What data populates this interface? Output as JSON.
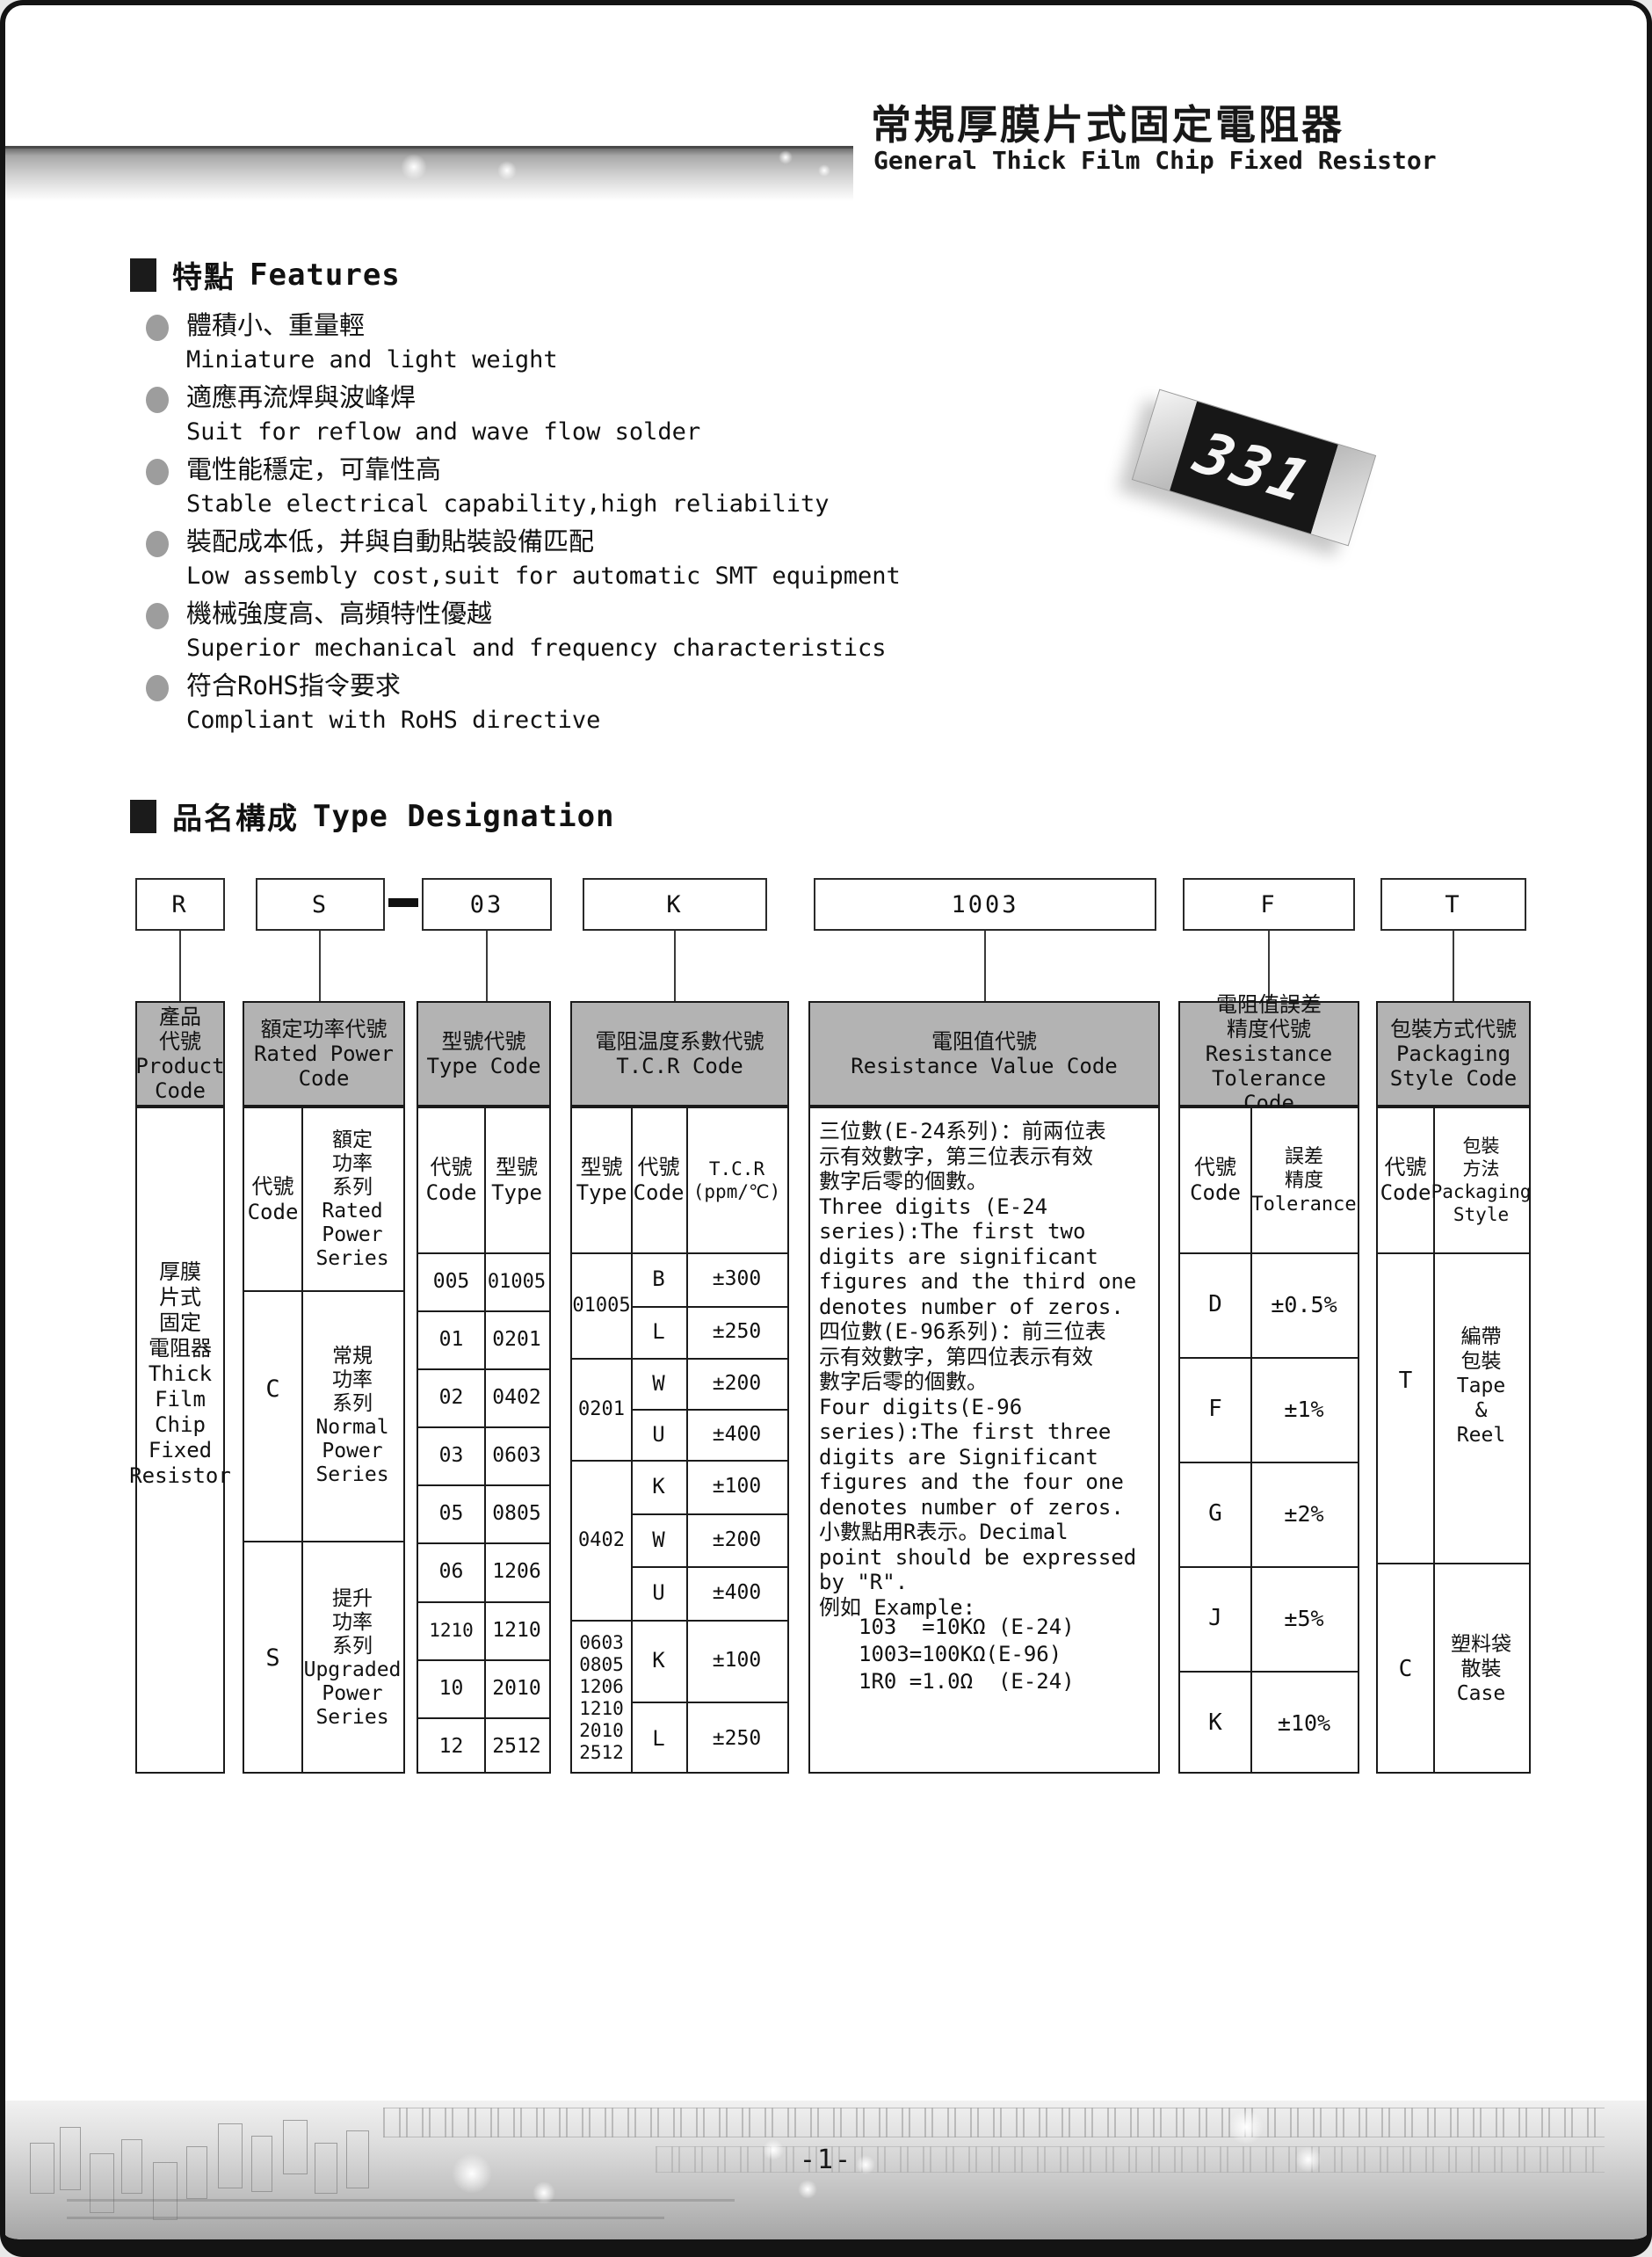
{
  "header": {
    "title_zh": "常規厚膜片式固定電阻器",
    "title_en": "General Thick Film Chip Fixed Resistor"
  },
  "features": {
    "heading_zh": "特點",
    "heading_en": "Features",
    "items": [
      {
        "zh": "體積小、重量輕",
        "en": "Miniature and light weight"
      },
      {
        "zh": "適應再流焊與波峰焊",
        "en": "Suit for reflow and wave flow solder"
      },
      {
        "zh": "電性能穩定，可靠性高",
        "en": "Stable electrical capability,high reliability"
      },
      {
        "zh": "裝配成本低，并與自動貼裝設備匹配",
        "en": "Low assembly cost,suit for automatic SMT equipment"
      },
      {
        "zh": "機械強度高、高頻特性優越",
        "en": "Superior mechanical and frequency characteristics"
      },
      {
        "zh": "符合RoHS指令要求",
        "en": "Compliant with RoHS directive"
      }
    ]
  },
  "chip": {
    "marking": "331"
  },
  "type_designation": {
    "heading_zh": "品名構成",
    "heading_en": "Type Designation",
    "codes": [
      "R",
      "S",
      "03",
      "K",
      "1003",
      "F",
      "T"
    ]
  },
  "table": {
    "headers": {
      "product": "產品\n代號\nProduct\nCode",
      "rated_power": "額定功率代號\nRated Power\nCode",
      "type": "型號代號\nType Code",
      "tcr": "電阻温度系數代號\nT.C.R Code",
      "resistance": "電阻值代號\nResistance Value Code",
      "tolerance": "電阻值誤差\n精度代號\nResistance\nTolerance Code",
      "packaging": "包裝方式代號\nPackaging\nStyle Code"
    },
    "subheaders": {
      "code": "代號\nCode",
      "rated_power_series": "額定\n功率\n系列\nRated\nPower\nSeries",
      "type_model": "型號\nType",
      "tcr_unit": "T.C.R\n(ppm/℃)",
      "tolerance_label": "誤差\n精度\nTolerance",
      "packaging_label": "包裝\n方法\nPackaging\nStyle"
    },
    "product_cell": "厚膜\n片式\n固定\n電阻器\nThick\nFilm\nChip\nFixed\nResistor",
    "rated_power_rows": [
      {
        "code": "C",
        "series": "常規\n功率\n系列\nNormal\nPower\nSeries"
      },
      {
        "code": "S",
        "series": "提升\n功率\n系列\nUpgraded\nPower\nSeries"
      }
    ],
    "type_rows": [
      [
        "005",
        "01005"
      ],
      [
        "01",
        "0201"
      ],
      [
        "02",
        "0402"
      ],
      [
        "03",
        "0603"
      ],
      [
        "05",
        "0805"
      ],
      [
        "06",
        "1206"
      ],
      [
        "1210",
        "1210"
      ],
      [
        "10",
        "2010"
      ],
      [
        "12",
        "2512"
      ]
    ],
    "tcr_groups": [
      {
        "label": "01005",
        "rows": [
          [
            "B",
            "±300"
          ],
          [
            "L",
            "±250"
          ]
        ]
      },
      {
        "label": "0201",
        "rows": [
          [
            "W",
            "±200"
          ],
          [
            "U",
            "±400"
          ]
        ]
      },
      {
        "label": "0402",
        "rows": [
          [
            "K",
            "±100"
          ],
          [
            "W",
            "±200"
          ],
          [
            "U",
            "±400"
          ]
        ]
      },
      {
        "label": "0603\n0805\n1206\n1210\n2010\n2512",
        "rows": [
          [
            "K",
            "±100"
          ],
          [
            "L",
            "±250"
          ]
        ]
      }
    ],
    "resistance_note": "三位數(E-24系列)：前兩位表\n示有效數字，第三位表示有效\n數字后零的個數。\nThree digits (E-24\nseries):The first two\ndigits are significant\nfigures and the third one\ndenotes number of zeros.\n四位數(E-96系列)：前三位表\n示有效數字，第四位表示有效\n數字后零的個數。\nFour digits(E-96\nseries):The first three\ndigits are Significant\nfigures and the four one\ndenotes number of zeros.\n小數點用R表示。Decimal\npoint should be expressed\nby \"R\".\n例如 Example:",
    "resistance_examples": "103  =10KΩ (E-24)\n1003=100KΩ(E-96)\n1R0 =1.0Ω  (E-24)",
    "tolerance_rows": [
      [
        "D",
        "±0.5%"
      ],
      [
        "F",
        "±1%"
      ],
      [
        "G",
        "±2%"
      ],
      [
        "J",
        "±5%"
      ],
      [
        "K",
        "±10%"
      ]
    ],
    "packaging_rows": [
      {
        "code": "T",
        "style": "編帶\n包裝\nTape\n&\nReel"
      },
      {
        "code": "C",
        "style": "塑料袋\n散裝\nCase"
      }
    ]
  },
  "footer": {
    "page_number": "-1-"
  }
}
